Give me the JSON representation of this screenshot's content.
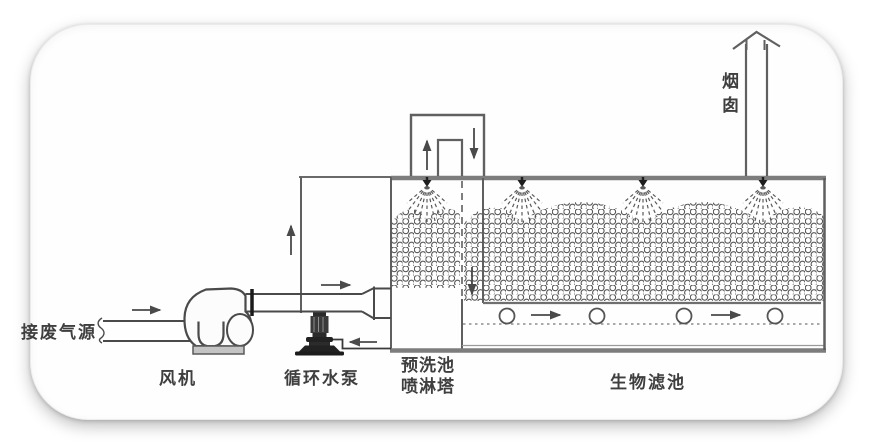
{
  "diagram": {
    "labels": {
      "waste_gas_source": "接废气源",
      "fan": "风机",
      "circulating_pump": "循环水泵",
      "prewash_line1": "预洗池",
      "prewash_line2": "喷淋塔",
      "biofilter": "生物滤池",
      "chimney": "烟囱"
    },
    "arrows": [
      {
        "name": "inlet-flow",
        "direction": "right"
      },
      {
        "name": "fan-outlet-flow",
        "direction": "right"
      },
      {
        "name": "tower-riser-flow",
        "direction": "up"
      },
      {
        "name": "duct-up-flow",
        "direction": "up"
      },
      {
        "name": "duct-down-flow",
        "direction": "down"
      },
      {
        "name": "biofilter-inlet-flow",
        "direction": "down"
      },
      {
        "name": "return-water-flow",
        "direction": "left"
      },
      {
        "name": "plenum-flow-1",
        "direction": "right"
      },
      {
        "name": "plenum-flow-2",
        "direction": "right"
      }
    ],
    "spray_nozzle_count": 4,
    "aeration_hole_count": 4,
    "colors": {
      "line": "#4a4a4a",
      "structure": "#7d7d7d",
      "text": "#3f3f3f",
      "dark_fill": "#2a2a2a",
      "card_background": "#fefefe"
    }
  }
}
